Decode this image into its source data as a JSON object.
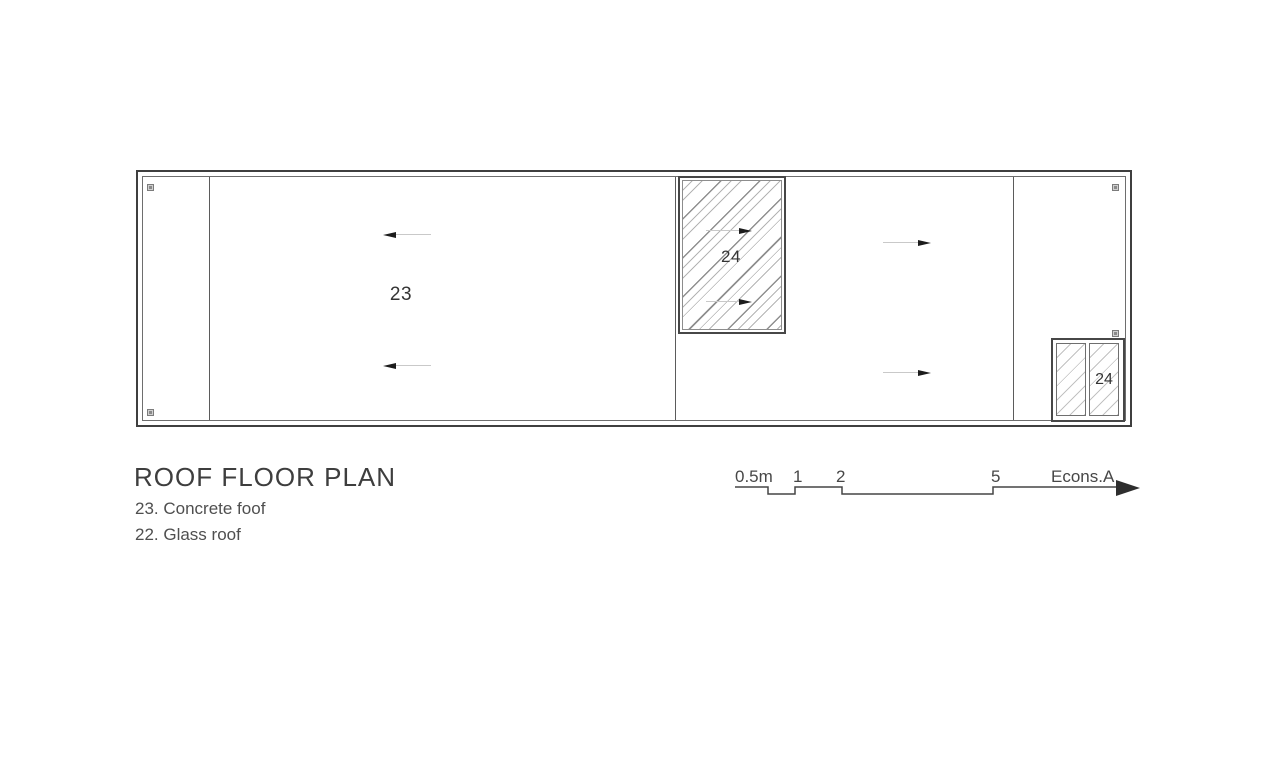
{
  "drawing": {
    "title": "ROOF FLOOR PLAN",
    "legend": [
      {
        "label": "23. Concrete foof"
      },
      {
        "label": "22. Glass roof"
      }
    ],
    "plan": {
      "concrete_area_label": "23",
      "skylight_label": "24",
      "small_skylight_label": "24"
    },
    "scale_bar": {
      "tick_labels": [
        "0.5m",
        "1",
        "2",
        "5"
      ],
      "signature": "Econs.A"
    },
    "colors": {
      "outline_dark": "#3f3f3f",
      "outline_medium": "#6e6e6e",
      "hatch_light": "#b4b4b4",
      "hatch_dark": "#8f8f8f",
      "arrow_head": "#1c1c1c",
      "arrow_shaft": "#c9c9c9",
      "marker_fill": "#d0d0d0",
      "text": "#4a4a4a"
    }
  }
}
